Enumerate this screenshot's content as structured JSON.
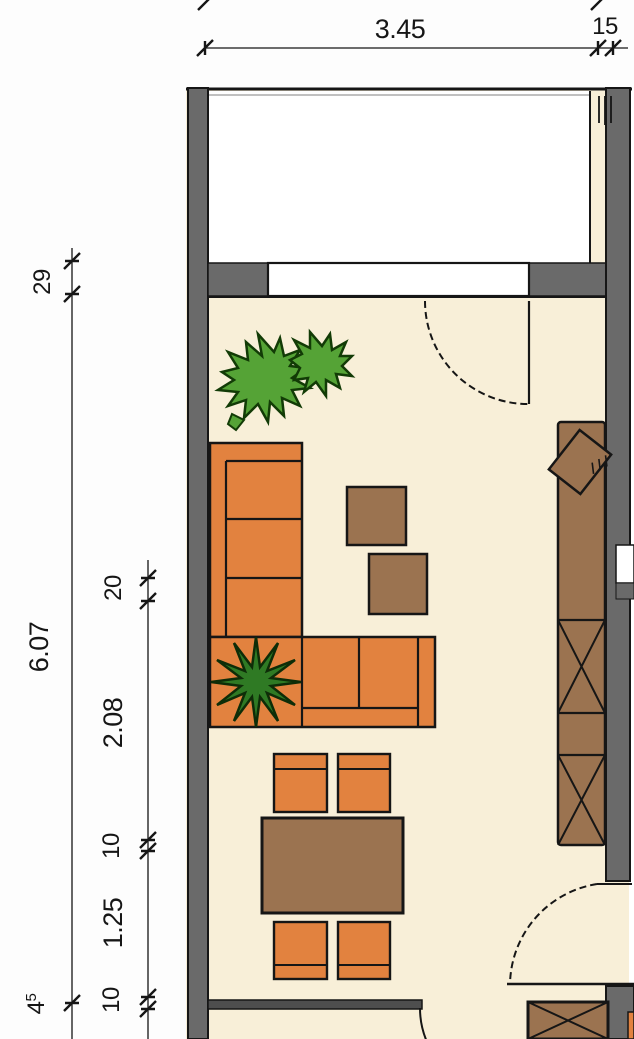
{
  "title": "apartment-living-room-floor-plan",
  "colors": {
    "floor": "#f8efd8",
    "balcony": "#ffffff",
    "wall": "#6a6a6a",
    "wall_dark": "#4e4e4e",
    "line": "#161616",
    "sofa": "#e2823f",
    "wood": "#9b7350",
    "plant": "#55a336",
    "plant_dark": "#2f7a24",
    "bg": "#fdfdfd"
  },
  "dims": {
    "top_main": "3.45",
    "top_wall": "15",
    "left_band": "29",
    "left_total": "6.07",
    "left_sill_main": "4",
    "left_sill_sup": "5",
    "inner_offset": "20",
    "inner_sofa": "2.08",
    "inner_gap_a": "10",
    "inner_dining": "1.25",
    "inner_gap_b": "10"
  },
  "rooms": {
    "living_room": "living room with L-sofa, side tables, dining set, sideboard and wardrobe",
    "balcony": "balcony above living room",
    "lower_room": "adjoining room below with cabinet"
  },
  "furniture": [
    "l-shaped-sofa",
    "corner-plant",
    "large-plant",
    "side-table",
    "side-table",
    "dining-table",
    "dining-chair-x4",
    "tv-on-sideboard",
    "wardrobe-x-sections",
    "lower-cabinet"
  ]
}
